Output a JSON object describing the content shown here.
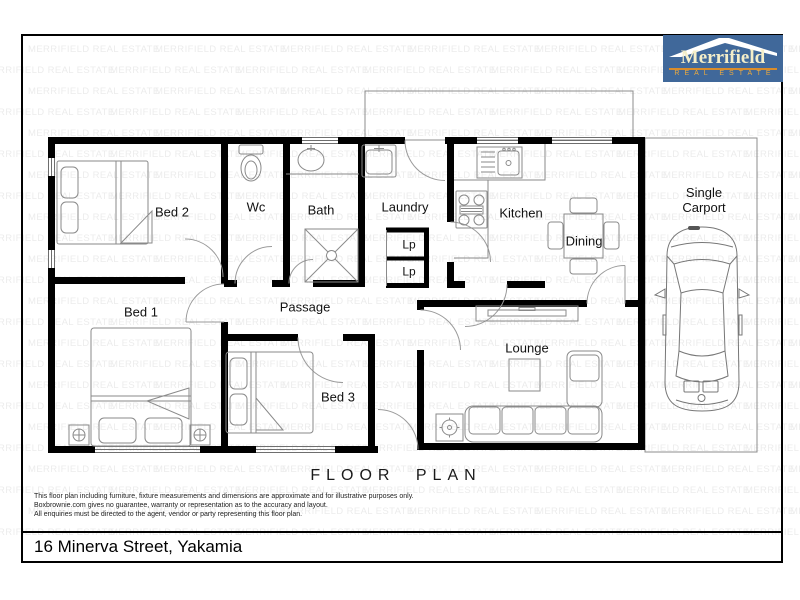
{
  "watermark": {
    "text": "MERRIFIELD REAL ESTATE",
    "color": "#ececec"
  },
  "logo": {
    "name": "Merrifield",
    "tagline": "REAL ESTATE",
    "bg_color": "#40689a",
    "name_color": "#f4eec9",
    "rule_color": "#d98c2b",
    "tagline_color": "#edaa3e"
  },
  "floorplan": {
    "title": "FLOOR PLAN",
    "rooms": [
      {
        "label": "Bed 2"
      },
      {
        "label": "Wc"
      },
      {
        "label": "Bath"
      },
      {
        "label": "Laundry"
      },
      {
        "label": "Kitchen"
      },
      {
        "label": "Dining"
      },
      {
        "label": "Lounge"
      },
      {
        "label": "Passage"
      },
      {
        "label": "Bed 1"
      },
      {
        "label": "Bed 3"
      },
      {
        "label": "Lp"
      },
      {
        "label": "Lp"
      },
      {
        "label": "Single\nCarport"
      }
    ]
  },
  "disclaimer": {
    "lines": [
      "This floor plan including furniture, fixture measurements and dimensions are approximate and for illustrative purposes only.",
      "Boxbrownie.com gives no guarantee, warranty or representation as to the accuracy and layout.",
      "All enquiries must be directed to the agent, vendor or party representing this floor plan."
    ]
  },
  "address": "16 Minerva Street, Yakamia"
}
